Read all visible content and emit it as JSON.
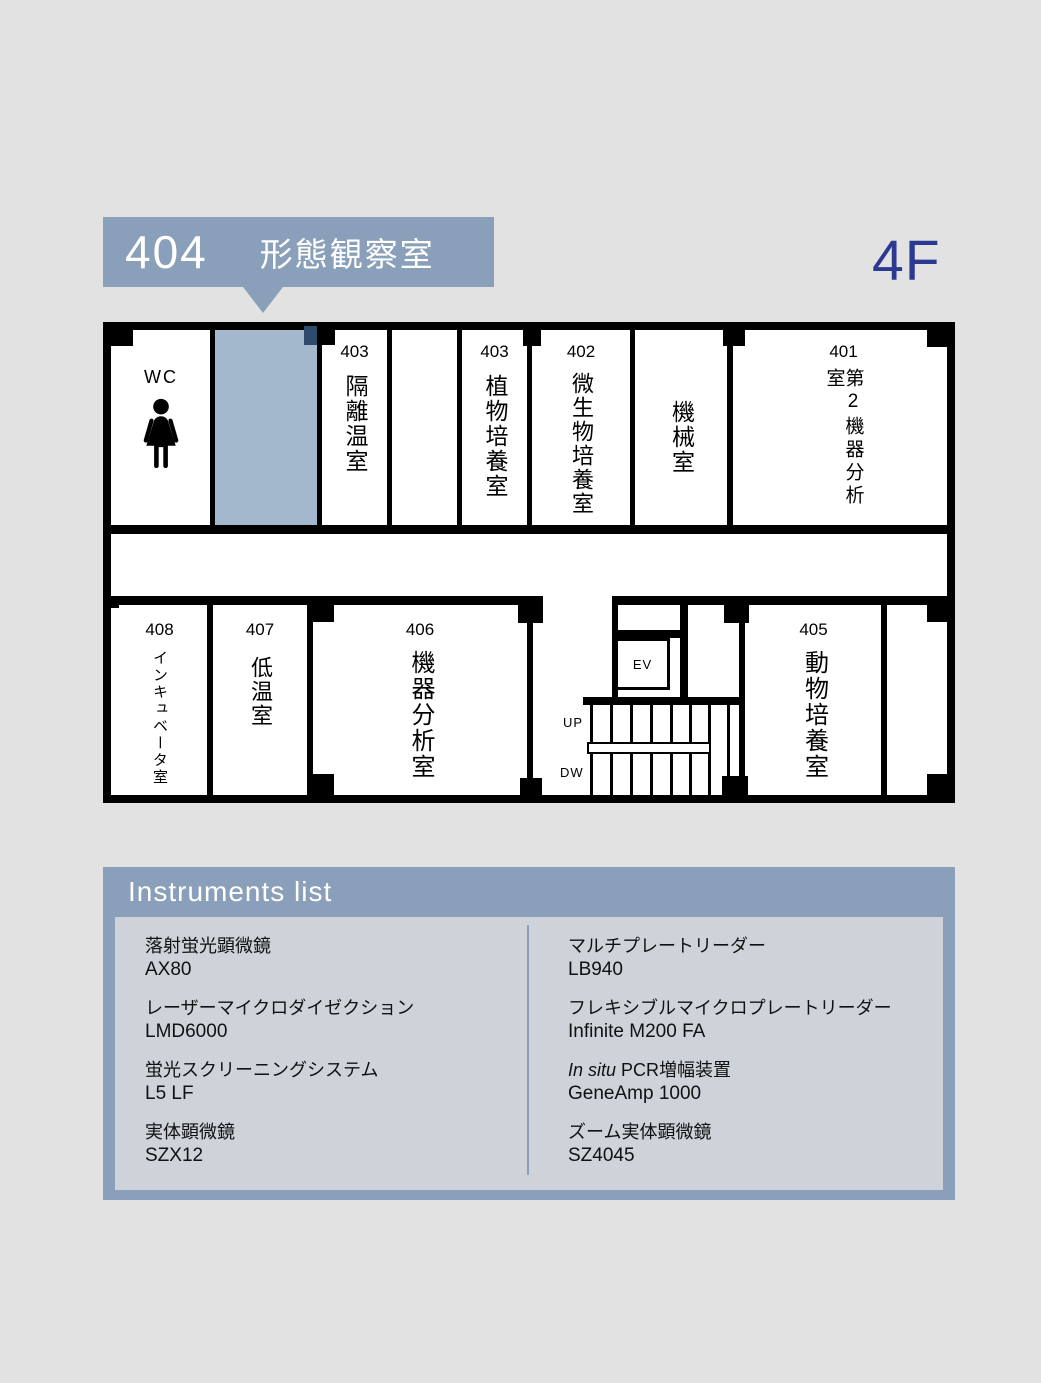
{
  "floor": {
    "label": "4F"
  },
  "callout": {
    "number": "404",
    "name": "形態観察室"
  },
  "plan": {
    "wc": {
      "label": "WC"
    },
    "rooms": {
      "r403a": {
        "number": "403",
        "name": "隔離温室"
      },
      "r403b": {
        "number": "403",
        "name": "植物培養室"
      },
      "r402": {
        "number": "402",
        "name": "微生物培養室"
      },
      "machine": {
        "name": "機械室"
      },
      "r401": {
        "number": "401",
        "name": "第2機器分析室"
      },
      "r408": {
        "number": "408",
        "name": "インキュベータ室"
      },
      "r407": {
        "number": "407",
        "name": "低温室"
      },
      "r406": {
        "number": "406",
        "name": "機器分析室"
      },
      "r405": {
        "number": "405",
        "name": "動物培養室"
      }
    },
    "elevator": {
      "label": "EV"
    },
    "stairs": {
      "up": "UP",
      "down": "DW"
    }
  },
  "instruments": {
    "title": "Instruments list",
    "columns": [
      {
        "items": [
          {
            "name": "落射蛍光顕微鏡",
            "model": "AX80"
          },
          {
            "name": "レーザーマイクロダイゼクション",
            "model": "LMD6000"
          },
          {
            "name": "蛍光スクリーニングシステム",
            "model": "L5 LF"
          },
          {
            "name": "実体顕微鏡",
            "model": "SZX12"
          }
        ]
      },
      {
        "items": [
          {
            "name": "マルチプレートリーダー",
            "model": "LB940"
          },
          {
            "name": "フレキシブルマイクロプレートリーダー",
            "model": "Infinite M200 FA"
          },
          {
            "name_italic": "In situ",
            "name": " PCR増幅装置",
            "model": "GeneAmp 1000"
          },
          {
            "name": "ズーム実体顕微鏡",
            "model": "SZ4045"
          }
        ]
      }
    ]
  },
  "colors": {
    "accent": "#8aa0ba",
    "highlight": "#a4b8cd",
    "floor_text": "#2b3a90",
    "panel_inner": "#cdd3d9"
  }
}
